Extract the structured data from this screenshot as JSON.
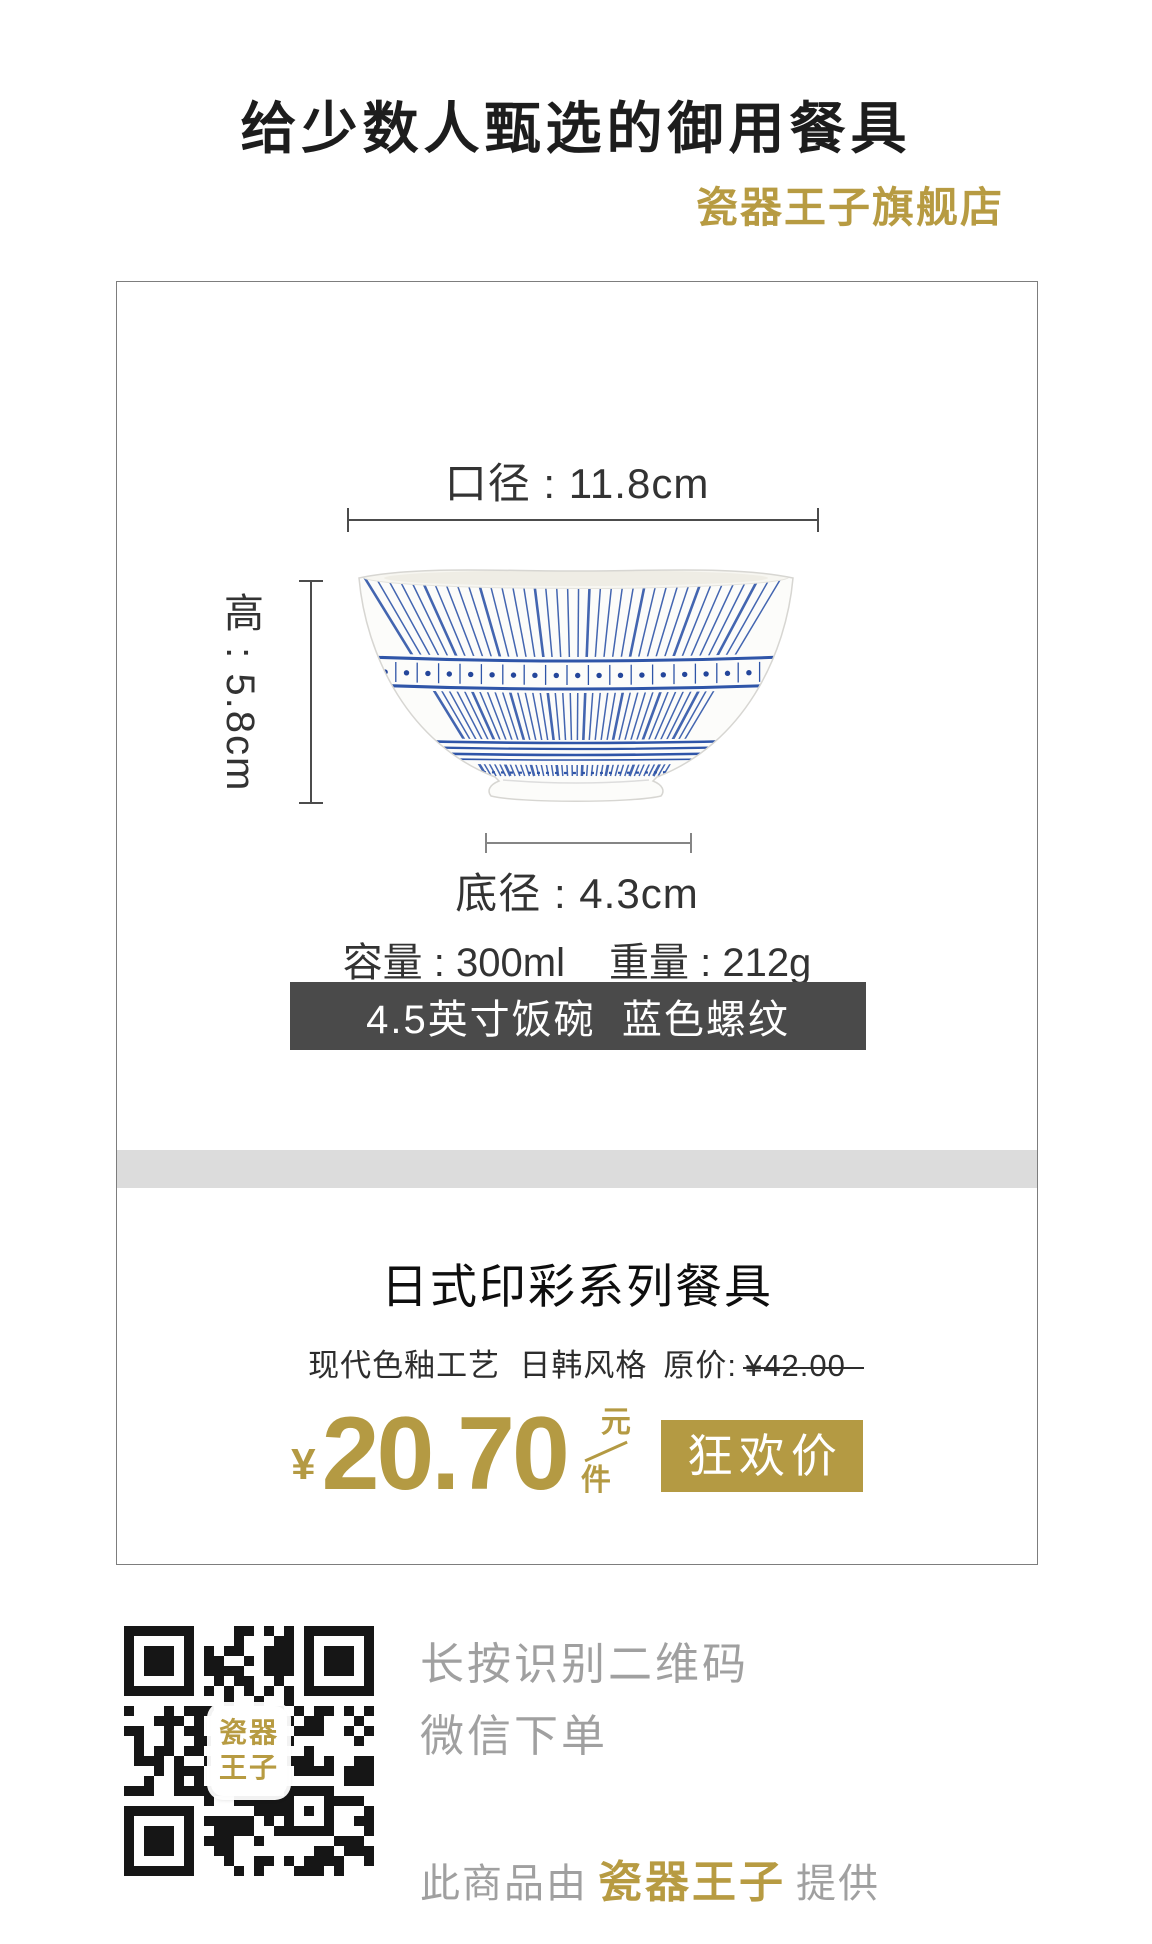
{
  "header": {
    "title": "给少数人甄选的御用餐具",
    "shop_name": "瓷器王子旗舰店"
  },
  "product_card": {
    "diameter_label": "口径 : 11.8cm",
    "height_label": "高 : 5.8cm",
    "base_diameter_label": "底径 : 4.3cm",
    "capacity_label": "容量 : 300ml",
    "weight_label": "重量 : 212g",
    "spec_banner": "4.5英寸饭碗  蓝色螺纹"
  },
  "product_info": {
    "series_title": "日式印彩系列餐具",
    "features": "现代色釉工艺  日韩风格",
    "original_price_label": "原价:",
    "original_price": "¥42.00",
    "currency_symbol": "¥",
    "price": "20.70",
    "unit_top": "元",
    "unit_bottom": "件",
    "promo_badge": "狂欢价"
  },
  "footer": {
    "qr_instruction_primary": "长按识别二维码",
    "qr_instruction_secondary": "微信下单",
    "qr_logo_line1": "瓷器",
    "qr_logo_line2": "王子",
    "provided_by_prefix": "此商品由",
    "provider_name": "瓷器王子",
    "provided_by_suffix": "提供"
  },
  "colors": {
    "accent_gold": "#b49a43",
    "spec_banner_bg": "#4a4a4a",
    "pattern_blue": "#2f55a8",
    "divider_gray": "#dcdcdc",
    "footer_text_gray": "#a0a0a0",
    "qr_black": "#161616"
  }
}
